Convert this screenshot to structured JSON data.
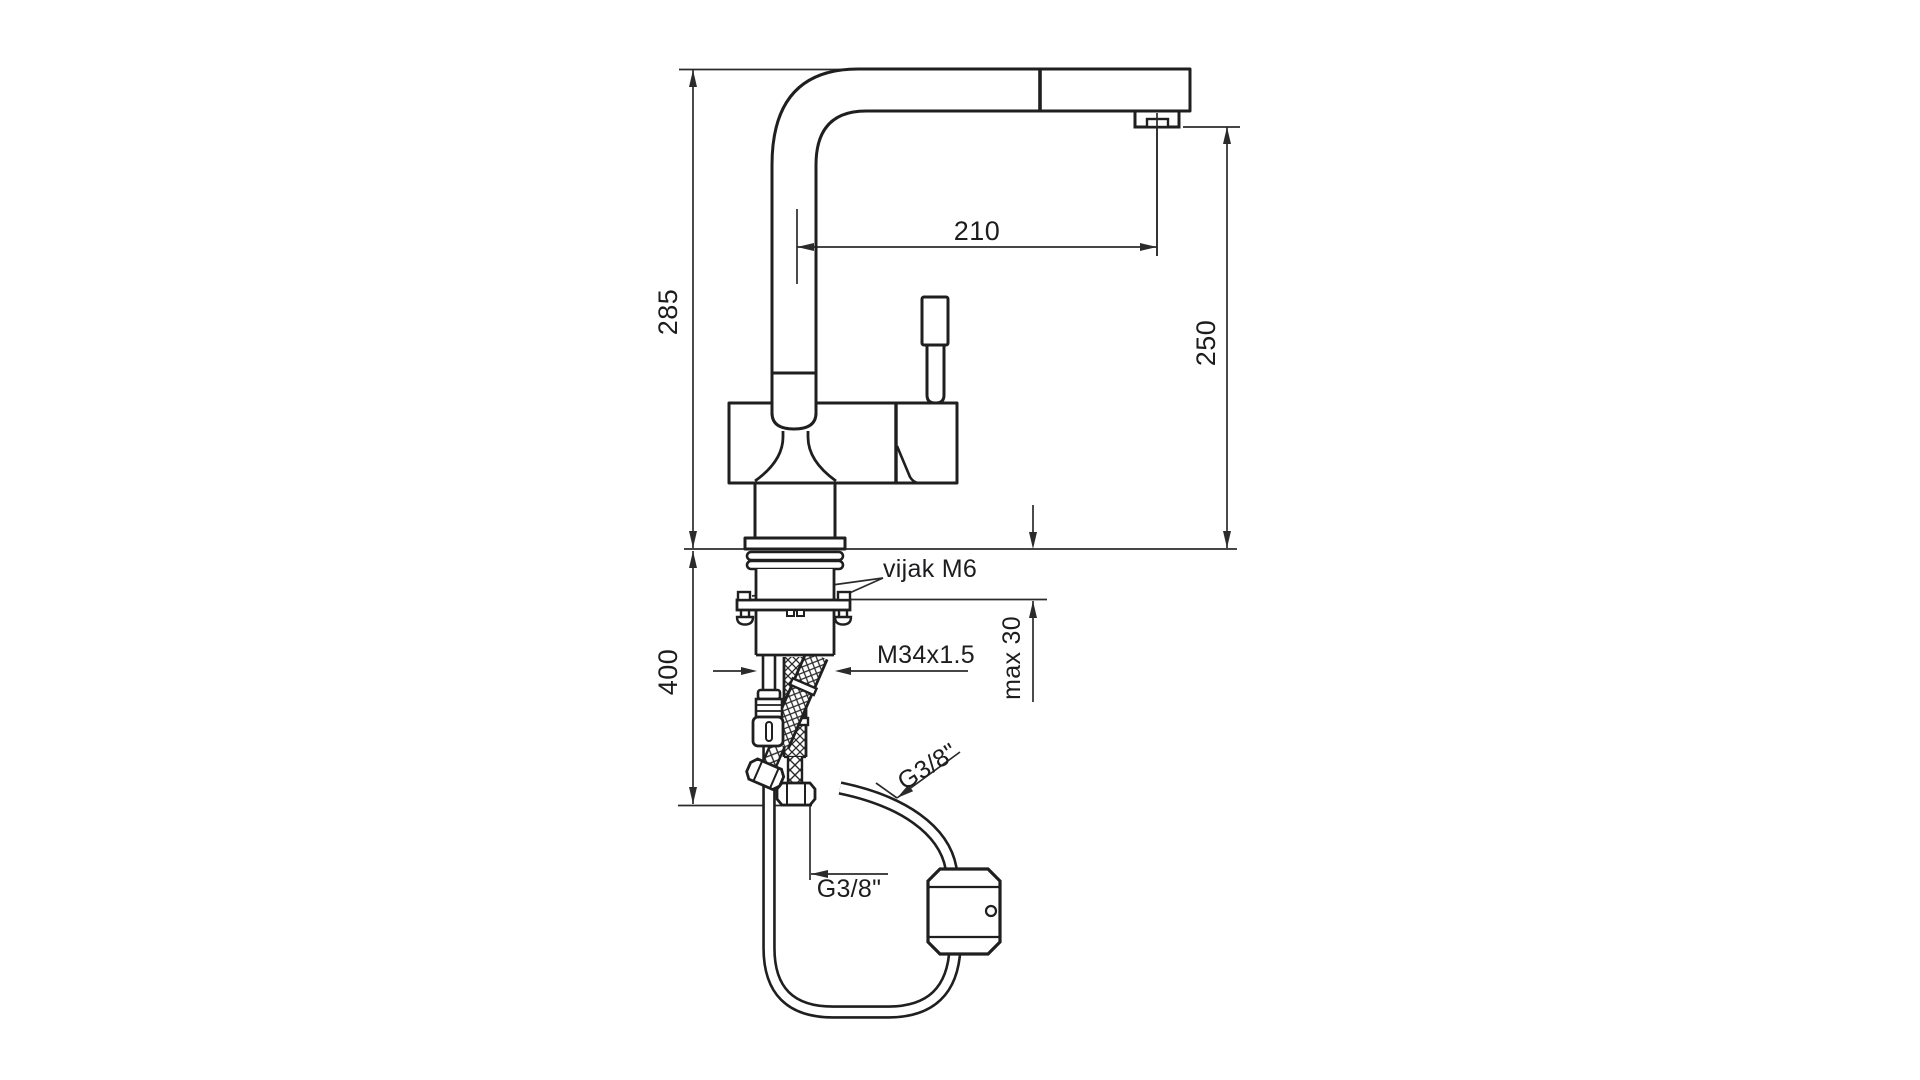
{
  "drawing": {
    "type": "technical dimension drawing",
    "subject": "single-lever kitchen faucet with pull-out spray, hose weight and flexible supply hoses"
  },
  "dimensions": {
    "overall_height": "285",
    "spout_reach": "210",
    "outlet_height": "250",
    "hose_drop": "400",
    "max_deck_thickness": "max 30",
    "shank_thread": "M34x1.5",
    "fixing_screw": "vijak M6",
    "supply_connection_side": "G3/8\"",
    "supply_connection_bottom": "G3/8\""
  },
  "colors": {
    "background": "#ffffff",
    "outline": "#1f1f1f",
    "dimension_lines": "#2b2b2b",
    "text": "#1d1d1f"
  }
}
